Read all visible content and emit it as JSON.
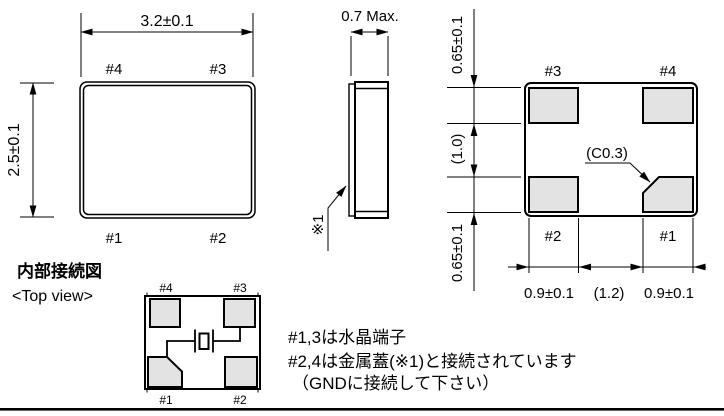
{
  "colors": {
    "line": "#000000",
    "pad_fill": "#e3e3e3",
    "background": "#ffffff"
  },
  "top_view": {
    "dim_width": "3.2±0.1",
    "dim_height": "2.5±0.1",
    "pin_top_left": "#4",
    "pin_top_right": "#3",
    "pin_bottom_left": "#1",
    "pin_bottom_right": "#2"
  },
  "side_view": {
    "dim_thickness": "0.7 Max.",
    "lid_ref": "※1"
  },
  "bottom_view": {
    "pad_top_left": "#3",
    "pad_top_right": "#4",
    "pad_bottom_left": "#2",
    "pad_bottom_right": "#1",
    "dim_top_pad": "0.65±0.1",
    "dim_mid_gap": "(1.0)",
    "dim_bottom_pad": "0.65±0.1",
    "dim_left_pad": "0.9±0.1",
    "dim_center_gap": "(1.2)",
    "dim_right_pad": "0.9±0.1",
    "chamfer": "(C0.3)"
  },
  "internal": {
    "title": "内部接続図",
    "subtitle": "<Top view>",
    "pin_top_left": "#4",
    "pin_top_right": "#3",
    "pin_bottom_left": "#1",
    "pin_bottom_right": "#2"
  },
  "notes": {
    "line1": "#1,3は水晶端子",
    "line2": "#2,4は金属蓋(※1)と接続されています",
    "line3": "（GNDに接続して下さい）"
  }
}
